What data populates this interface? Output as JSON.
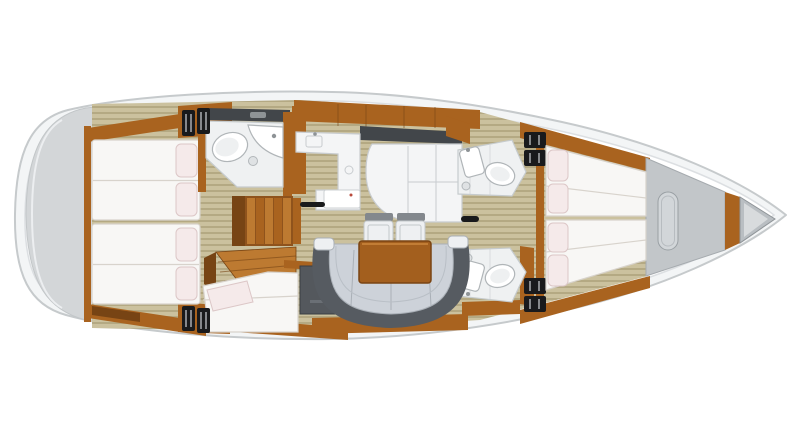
{
  "diagram": {
    "kind": "sailboat-interior-floor-plan",
    "view": "top-down, bow pointing right",
    "areas": {
      "swim_platform": "stern swim platform",
      "aft_cabin_port": "aft double-berth cabin (top) with two pillows",
      "aft_cabin_starboard": "aft double-berth cabin (bottom) with two pillows",
      "aft_head": "aft bathroom with toilet, corner sink and shower drain",
      "companionway": "companionway stairs",
      "nav_station": "nav seat with single berth beside engine hatch",
      "galley": "L-shaped galley counter with island console",
      "salon": "salon with curved sofa, wooden table and two chairs",
      "fwd_head_port": "forward bathroom (top) with toilet and sink",
      "fwd_head_starboard": "forward bathroom (bottom) with toilet and sink",
      "fwd_cabin": "forward V-berth cabin, two tapering beds with four pillows",
      "bow": "bow deck hatch, bulkhead and anchor locker"
    }
  },
  "colors": {
    "hull_fill": "#f3f5f6",
    "hull_stroke": "#c6cacc",
    "deck_line": "#dcdfe2",
    "transom": "#d3d6d8",
    "transom_edge": "#c2c6c8",
    "transom_line": "#eceef0",
    "floor_base": "#cbc19e",
    "floor_stripe": "#b4a983",
    "wood": "#a9631f",
    "wood_dark": "#774414",
    "wood_mid": "#8f531c",
    "wood_light": "#bd7a31",
    "dark_wall": "#42464a",
    "black": "#191a1c",
    "mattress": "#f8f7f5",
    "mattress_line": "#d8d3cc",
    "pillow": "#f5eaea",
    "pillow_line": "#dcc7c7",
    "bath": "#eff1f2",
    "bath_line": "#c6cbcd",
    "fixture_line": "#b0b5b8",
    "counter": "#f4f5f6",
    "counter_line": "#c8cccf",
    "nav_seat": "#54585d",
    "sofa_seat": "#cdd2d9",
    "sofa_dark": "#565b61",
    "sofa_line": "#aab0b7",
    "sofa_inner": "#b9bfc6",
    "chair_body": "#eef0f2",
    "chair_back": "#83888d",
    "chair_line": "#c3c8cb",
    "table": "#a35f1e",
    "table_border": "#7a4413",
    "table_hi": "#c27d35",
    "bow_deck": "#c2c6c9",
    "bow_deck_line": "#a6abaf",
    "anchor": "#b9bec2",
    "anchor_inner": "#d8dbdd"
  }
}
